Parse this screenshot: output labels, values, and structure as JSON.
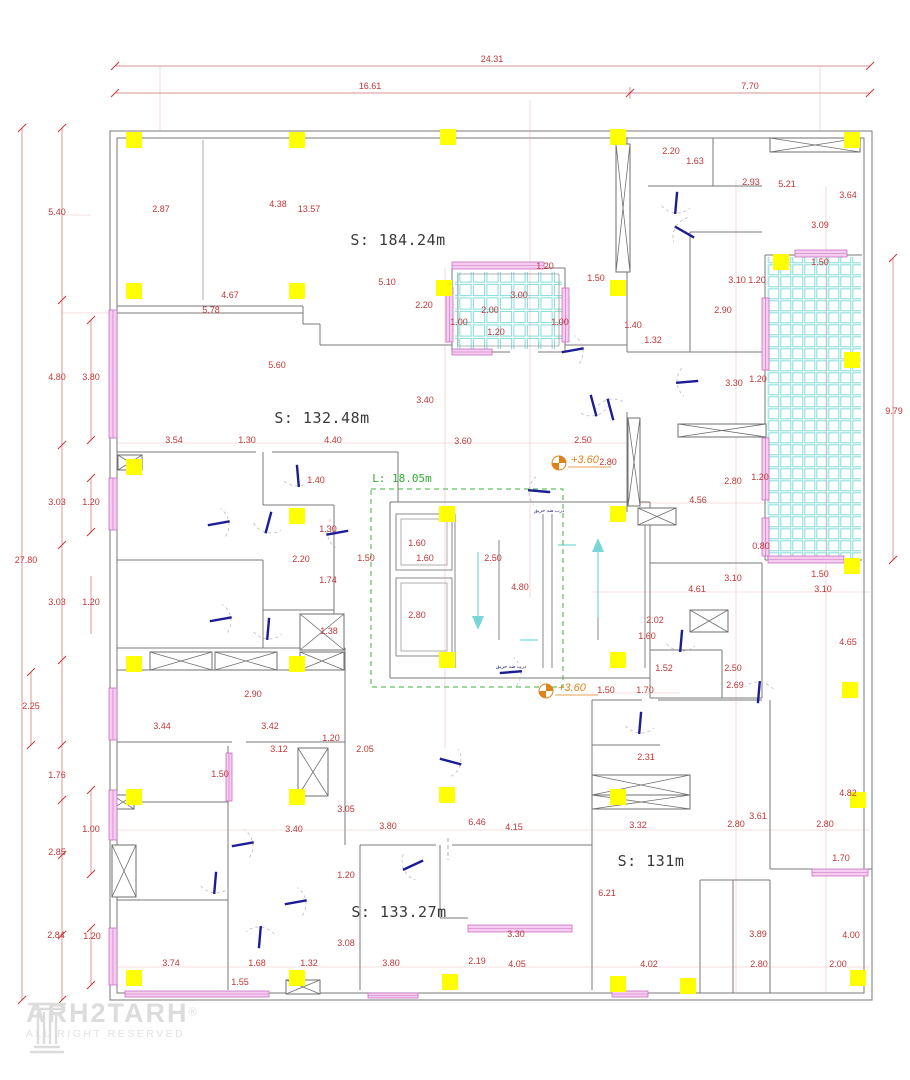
{
  "drawing": {
    "type": "architectural floor plan",
    "colors": {
      "dimension_red": "#c43636",
      "wall_gray": "#787878",
      "column_yellow": "#ffff00",
      "tile_cyan": "#84dcdc",
      "window_pink": "#e9a0e0",
      "door_blue": "#1c1c96",
      "stair_length_green": "#2fae2f",
      "level_orange": "#e0821a",
      "watermark_gray": "#dcdcdc"
    },
    "area_labels": [
      {
        "text": "S: 184.24m",
        "x": 398,
        "y": 245
      },
      {
        "text": "S: 132.48m",
        "x": 322,
        "y": 423
      },
      {
        "text": "S: 131m",
        "x": 651,
        "y": 866
      },
      {
        "text": "S: 133.27m",
        "x": 399,
        "y": 917
      }
    ],
    "length_label": {
      "text": "L: 18.05m",
      "x": 402,
      "y": 482
    },
    "level_markers": [
      {
        "text": "+3.60",
        "icon_x": 559,
        "icon_y": 463
      },
      {
        "text": "+3.60",
        "icon_x": 546,
        "icon_y": 691
      }
    ],
    "door_notes": [
      {
        "text": "درب ضد حریق",
        "x": 549,
        "y": 512
      },
      {
        "text": "درب ضد حریق",
        "x": 511,
        "y": 668
      }
    ],
    "watermark": {
      "brand": "ARH2TARH",
      "registered": "®",
      "subtitle": "ALL RIGHT RESERVED"
    },
    "dimension_labels": [
      {
        "v": "24.31",
        "x": 492,
        "y": 62
      },
      {
        "v": "16.61",
        "x": 370,
        "y": 89
      },
      {
        "v": "7.70",
        "x": 750,
        "y": 89
      },
      {
        "v": "27.80",
        "x": 26,
        "y": 563
      },
      {
        "v": "5.40",
        "x": 57,
        "y": 215
      },
      {
        "v": "4.80",
        "x": 57,
        "y": 380
      },
      {
        "v": "3.80",
        "x": 91,
        "y": 380
      },
      {
        "v": "3.03",
        "x": 57,
        "y": 505
      },
      {
        "v": "1.20",
        "x": 91,
        "y": 505
      },
      {
        "v": "3.03",
        "x": 57,
        "y": 605
      },
      {
        "v": "1.20",
        "x": 91,
        "y": 605
      },
      {
        "v": "2.25",
        "x": 31,
        "y": 709
      },
      {
        "v": "1.76",
        "x": 57,
        "y": 778
      },
      {
        "v": "1.00",
        "x": 91,
        "y": 832
      },
      {
        "v": "2.85",
        "x": 57,
        "y": 855
      },
      {
        "v": "2.84",
        "x": 56,
        "y": 938
      },
      {
        "v": "1.20",
        "x": 92,
        "y": 939
      },
      {
        "v": "2.87",
        "x": 161,
        "y": 212
      },
      {
        "v": "4.38",
        "x": 278,
        "y": 207
      },
      {
        "v": "13.57",
        "x": 309,
        "y": 212
      },
      {
        "v": "4.67",
        "x": 230,
        "y": 298
      },
      {
        "v": "5.78",
        "x": 211,
        "y": 313
      },
      {
        "v": "5.60",
        "x": 277,
        "y": 368
      },
      {
        "v": "5.10",
        "x": 387,
        "y": 285
      },
      {
        "v": "2.20",
        "x": 424,
        "y": 308
      },
      {
        "v": "1.20",
        "x": 545,
        "y": 269
      },
      {
        "v": "1.50",
        "x": 596,
        "y": 281
      },
      {
        "v": "3.00",
        "x": 519,
        "y": 298
      },
      {
        "v": "2.00",
        "x": 490,
        "y": 313
      },
      {
        "v": "1.00",
        "x": 459,
        "y": 325
      },
      {
        "v": "1.00",
        "x": 560,
        "y": 325
      },
      {
        "v": "1.20",
        "x": 496,
        "y": 335
      },
      {
        "v": "1.40",
        "x": 633,
        "y": 328
      },
      {
        "v": "1.32",
        "x": 653,
        "y": 343
      },
      {
        "v": "2.20",
        "x": 671,
        "y": 154
      },
      {
        "v": "1.63",
        "x": 695,
        "y": 164
      },
      {
        "v": "2.93",
        "x": 751,
        "y": 185
      },
      {
        "v": "5.21",
        "x": 787,
        "y": 187
      },
      {
        "v": "3.64",
        "x": 848,
        "y": 198
      },
      {
        "v": "3.09",
        "x": 820,
        "y": 228
      },
      {
        "v": "3.10",
        "x": 737,
        "y": 283
      },
      {
        "v": "1.20",
        "x": 757,
        "y": 283
      },
      {
        "v": "2.90",
        "x": 723,
        "y": 313
      },
      {
        "v": "1.50",
        "x": 820,
        "y": 265
      },
      {
        "v": "3.30",
        "x": 734,
        "y": 386
      },
      {
        "v": "1.20",
        "x": 758,
        "y": 382
      },
      {
        "v": "9.79",
        "x": 894,
        "y": 414
      },
      {
        "v": "2.80",
        "x": 733,
        "y": 484
      },
      {
        "v": "1.20",
        "x": 760,
        "y": 480
      },
      {
        "v": "4.56",
        "x": 698,
        "y": 503
      },
      {
        "v": "0.80",
        "x": 761,
        "y": 549
      },
      {
        "v": "1.50",
        "x": 820,
        "y": 577
      },
      {
        "v": "3.10",
        "x": 823,
        "y": 592
      },
      {
        "v": "3.10",
        "x": 733,
        "y": 581
      },
      {
        "v": "4.61",
        "x": 697,
        "y": 592
      },
      {
        "v": "3.54",
        "x": 174,
        "y": 443
      },
      {
        "v": "1.30",
        "x": 247,
        "y": 443
      },
      {
        "v": "4.40",
        "x": 333,
        "y": 443
      },
      {
        "v": "3.40",
        "x": 425,
        "y": 403
      },
      {
        "v": "3.60",
        "x": 463,
        "y": 444
      },
      {
        "v": "2.50",
        "x": 583,
        "y": 443
      },
      {
        "v": "2.80",
        "x": 608,
        "y": 465
      },
      {
        "v": "1.40",
        "x": 316,
        "y": 483
      },
      {
        "v": "1.30",
        "x": 328,
        "y": 532
      },
      {
        "v": "2.20",
        "x": 301,
        "y": 562
      },
      {
        "v": "1.74",
        "x": 328,
        "y": 583
      },
      {
        "v": "1.38",
        "x": 329,
        "y": 634
      },
      {
        "v": "2.90",
        "x": 253,
        "y": 697
      },
      {
        "v": "1.50",
        "x": 366,
        "y": 561
      },
      {
        "v": "1.60",
        "x": 417,
        "y": 546
      },
      {
        "v": "1.60",
        "x": 425,
        "y": 561
      },
      {
        "v": "2.50",
        "x": 493,
        "y": 561
      },
      {
        "v": "4.80",
        "x": 520,
        "y": 590
      },
      {
        "v": "2.80",
        "x": 417,
        "y": 618
      },
      {
        "v": "2.02",
        "x": 655,
        "y": 623
      },
      {
        "v": "1.60",
        "x": 647,
        "y": 639
      },
      {
        "v": "1.52",
        "x": 664,
        "y": 671
      },
      {
        "v": "2.50",
        "x": 733,
        "y": 671
      },
      {
        "v": "2.69",
        "x": 735,
        "y": 688
      },
      {
        "v": "1.50",
        "x": 606,
        "y": 693
      },
      {
        "v": "1.70",
        "x": 645,
        "y": 693
      },
      {
        "v": "4.65",
        "x": 848,
        "y": 645
      },
      {
        "v": "2.31",
        "x": 646,
        "y": 760
      },
      {
        "v": "4.82",
        "x": 848,
        "y": 796
      },
      {
        "v": "3.44",
        "x": 162,
        "y": 729
      },
      {
        "v": "3.42",
        "x": 270,
        "y": 729
      },
      {
        "v": "1.20",
        "x": 331,
        "y": 741
      },
      {
        "v": "3.12",
        "x": 279,
        "y": 752
      },
      {
        "v": "2.05",
        "x": 365,
        "y": 752
      },
      {
        "v": "1.50",
        "x": 220,
        "y": 777
      },
      {
        "v": "3.05",
        "x": 346,
        "y": 812
      },
      {
        "v": "3.40",
        "x": 294,
        "y": 832
      },
      {
        "v": "3.80",
        "x": 388,
        "y": 829
      },
      {
        "v": "6.46",
        "x": 477,
        "y": 825
      },
      {
        "v": "4.15",
        "x": 514,
        "y": 830
      },
      {
        "v": "3.32",
        "x": 638,
        "y": 828
      },
      {
        "v": "2.80",
        "x": 736,
        "y": 827
      },
      {
        "v": "2.80",
        "x": 825,
        "y": 827
      },
      {
        "v": "3.61",
        "x": 758,
        "y": 819
      },
      {
        "v": "1.70",
        "x": 841,
        "y": 861
      },
      {
        "v": "1.20",
        "x": 346,
        "y": 878
      },
      {
        "v": "6.21",
        "x": 607,
        "y": 896
      },
      {
        "v": "3.30",
        "x": 516,
        "y": 937
      },
      {
        "v": "3.08",
        "x": 346,
        "y": 946
      },
      {
        "v": "3.89",
        "x": 758,
        "y": 937
      },
      {
        "v": "4.00",
        "x": 851,
        "y": 938
      },
      {
        "v": "3.74",
        "x": 171,
        "y": 966
      },
      {
        "v": "1.68",
        "x": 257,
        "y": 966
      },
      {
        "v": "1.32",
        "x": 309,
        "y": 966
      },
      {
        "v": "3.80",
        "x": 391,
        "y": 966
      },
      {
        "v": "2.19",
        "x": 477,
        "y": 964
      },
      {
        "v": "4.05",
        "x": 517,
        "y": 967
      },
      {
        "v": "4.02",
        "x": 649,
        "y": 967
      },
      {
        "v": "2.80",
        "x": 759,
        "y": 967
      },
      {
        "v": "2.00",
        "x": 838,
        "y": 967
      },
      {
        "v": "1.55",
        "x": 240,
        "y": 985
      }
    ]
  }
}
